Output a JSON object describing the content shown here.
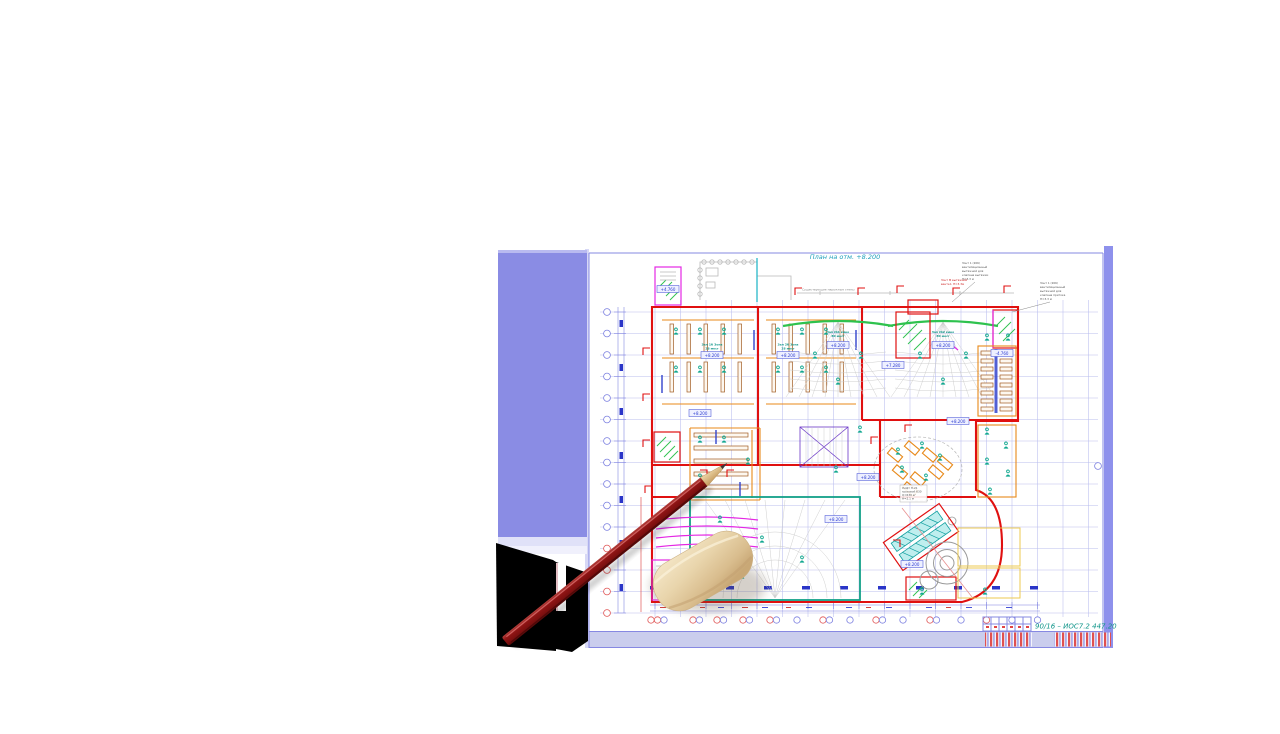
{
  "doc": {
    "title": "План на отм. +8.200",
    "code": "90/16  –  ИОС7.2 447.20"
  },
  "plan": {
    "note_existing_walls": "Существующие наружные стены",
    "elev": [
      "+4.760",
      "+8.200",
      "+8.200",
      "+8.200",
      "+8.200",
      "+8.200",
      "+7.280",
      "-4.760",
      "+8.200",
      "+8.200",
      "+8.200",
      "+8.200"
    ],
    "rooms": [
      {
        "l1": "Зал 1б Зона",
        "l2": "28 мест"
      },
      {
        "l1": "Зал 2б Зона",
        "l2": "28 мест"
      },
      {
        "l1": "Зал №1 кино",
        "l2": "80 мест"
      },
      {
        "l1": "Зал №2 кино",
        "l2": "80 мест"
      }
    ],
    "ann1": [
      "Зонт 1 (206)",
      "вентиляционный",
      "вытяжной для",
      "клапана вытяжки",
      "Н=3.3 м"
    ],
    "ann2": [
      "Зонт 1 (206)",
      "вентиляционный",
      "вытяжной для",
      "клапана притока",
      "Н=3.3 м"
    ],
    "ann_red": [
      "Зонт М вытяжной",
      "венткл. Н=3.3м"
    ],
    "lift": [
      "Лифт П-21",
      "грузовой 630",
      "Q=630 кг",
      "Н=2.1 м"
    ]
  },
  "colors": {
    "side_panel": "#8a8ce4",
    "sheet_band": "#cacded",
    "wall_red": "#e01010",
    "accent_teal": "#12a890",
    "accent_orange": "#e8891a",
    "accent_magenta": "#e428e4",
    "dimension_blue": "#7b7fe0",
    "pencil_red": "#8e1414",
    "eraser_beige": "#e9d5ac",
    "code_teal": "#0d9488"
  }
}
